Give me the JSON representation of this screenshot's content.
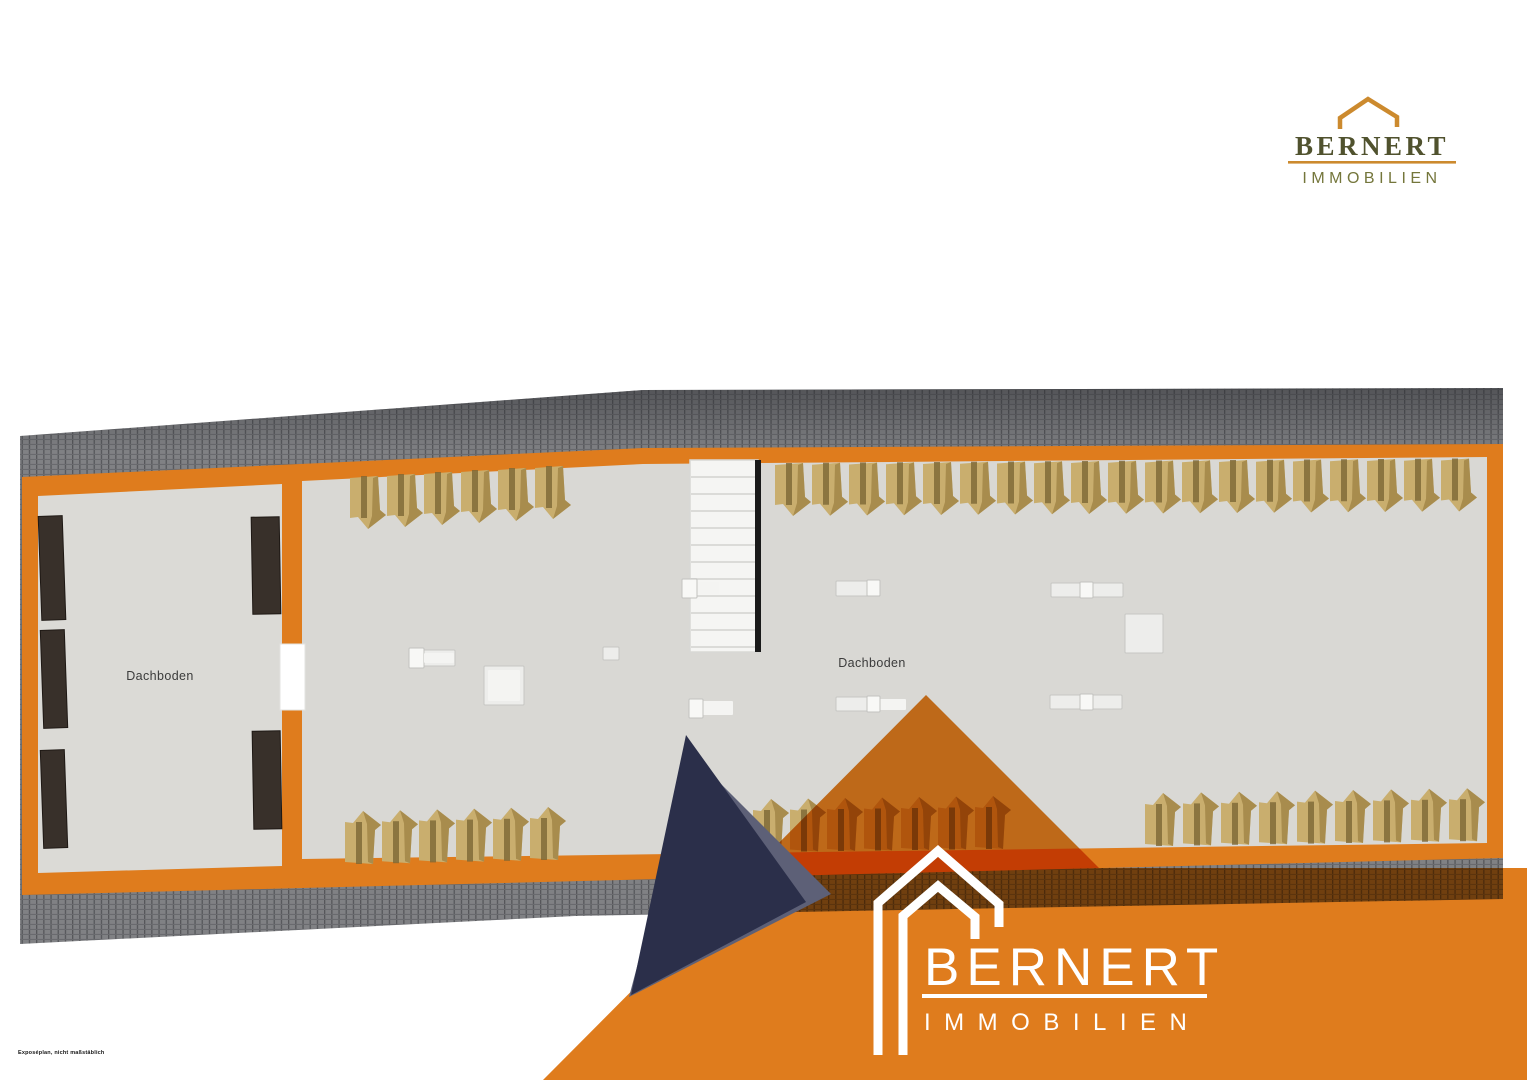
{
  "branding": {
    "header_logo": {
      "brand": "BERNERT",
      "subtitle": "IMMOBILIEN"
    },
    "watermark_logo": {
      "brand": "BERNERT",
      "subtitle": "IMMOBILIEN"
    }
  },
  "footer": {
    "disclaimer": "Exposéplan, nicht maßstäblich"
  },
  "floorplan": {
    "rooms": [
      {
        "label": "Dachboden"
      },
      {
        "label": "Dachboden"
      }
    ],
    "trusses": {
      "rows": [
        {
          "name": "top-middle",
          "xs": [
            365,
            402,
            439,
            476,
            513,
            550
          ],
          "y0": 476,
          "dy": -2,
          "flip": false
        },
        {
          "name": "top-right",
          "xs": [
            790,
            827,
            864,
            901,
            938,
            975,
            1012,
            1049,
            1086,
            1123,
            1160,
            1197,
            1234,
            1271,
            1308,
            1345,
            1382,
            1419,
            1456
          ],
          "y0": 463,
          "dy": -0.25,
          "flip": false
        },
        {
          "name": "bottom-middle",
          "xs": [
            360,
            397,
            434,
            471,
            508,
            545
          ],
          "y0": 864,
          "dy": -0.8,
          "flip": true
        },
        {
          "name": "bottom-right-a",
          "xs": [
            768,
            805,
            842,
            879,
            916,
            953,
            990
          ],
          "y0": 852,
          "dy": -0.5,
          "flip": true
        },
        {
          "name": "bottom-right-b",
          "xs": [
            1160,
            1198,
            1236,
            1274,
            1312,
            1350,
            1388,
            1426,
            1464
          ],
          "y0": 846,
          "dy": -0.6,
          "flip": true
        }
      ]
    },
    "furniture": [
      {
        "x": 40,
        "y": 516,
        "w": 24,
        "h": 104,
        "rot": -2
      },
      {
        "x": 42,
        "y": 630,
        "w": 24,
        "h": 98,
        "rot": -2
      },
      {
        "x": 42,
        "y": 750,
        "w": 24,
        "h": 98,
        "rot": -2
      },
      {
        "x": 252,
        "y": 517,
        "w": 28,
        "h": 97,
        "rot": -1
      },
      {
        "x": 253,
        "y": 731,
        "w": 28,
        "h": 98,
        "rot": -1
      }
    ],
    "floor_objects": [
      {
        "parts": [
          [
            409,
            650,
            46,
            16,
            "a"
          ],
          [
            409,
            648,
            15,
            20,
            "b"
          ],
          [
            424,
            653,
            30,
            10,
            "c"
          ]
        ]
      },
      {
        "parts": [
          [
            484,
            666,
            40,
            39,
            "a"
          ],
          [
            488,
            670,
            32,
            31,
            "c"
          ]
        ]
      },
      {
        "parts": [
          [
            603,
            647,
            16,
            13,
            "a"
          ]
        ]
      },
      {
        "parts": [
          [
            697,
            582,
            22,
            12,
            "c"
          ],
          [
            682,
            579,
            15,
            19,
            "b"
          ]
        ]
      },
      {
        "parts": [
          [
            703,
            701,
            30,
            14,
            "c"
          ],
          [
            689,
            699,
            14,
            19,
            "b"
          ]
        ]
      },
      {
        "parts": [
          [
            836,
            581,
            44,
            15,
            "a"
          ],
          [
            867,
            580,
            13,
            16,
            "b"
          ]
        ]
      },
      {
        "parts": [
          [
            836,
            697,
            44,
            14,
            "a"
          ],
          [
            880,
            699,
            26,
            11,
            "c"
          ],
          [
            867,
            696,
            13,
            16,
            "b"
          ]
        ]
      },
      {
        "parts": [
          [
            1051,
            583,
            72,
            14,
            "a"
          ],
          [
            1080,
            582,
            13,
            16,
            "b"
          ]
        ]
      },
      {
        "parts": [
          [
            1050,
            695,
            72,
            14,
            "a"
          ],
          [
            1080,
            694,
            13,
            16,
            "b"
          ]
        ]
      },
      {
        "parts": [
          [
            1125,
            614,
            38,
            39,
            "a"
          ]
        ]
      }
    ]
  },
  "colors": {
    "accent_orange": "#DF7C1D",
    "roof_tile_gray": "#808184",
    "floor_gray": "#DBDAD6",
    "truss_tan": "#C9AE6E",
    "truss_shadow": "#A28648",
    "furniture_dark": "#38302A",
    "triangle_navy": "#2B2F4A",
    "triangle_slate": "#5D6077",
    "logo_olive_dark": "#50522E",
    "logo_olive_light": "#74763B",
    "logo_orange": "#CC8A2E",
    "stair_stringer_black": "#1A1A1A",
    "white": "#FFFFFF"
  }
}
